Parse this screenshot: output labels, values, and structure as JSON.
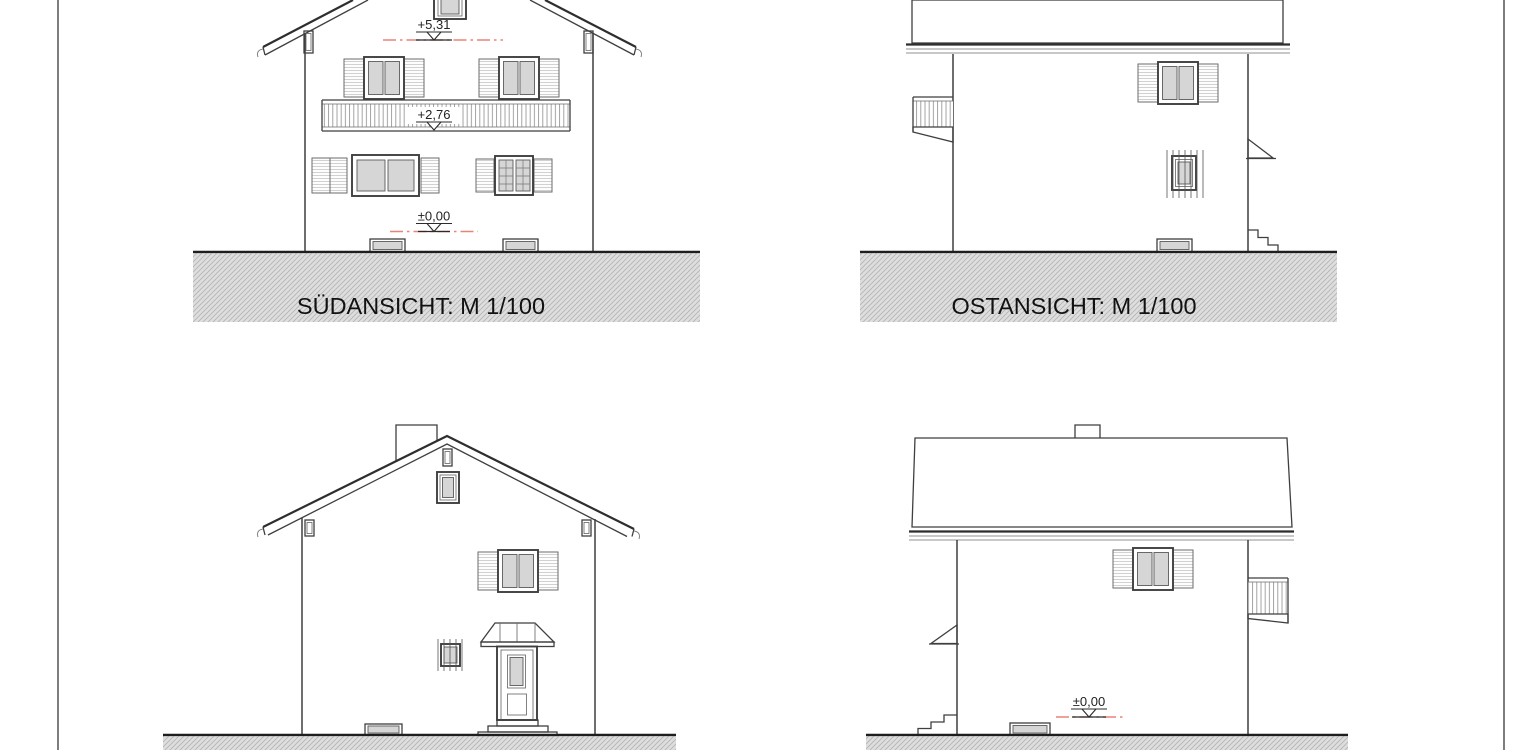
{
  "sheet": {
    "drawing_type": "house elevation drawings (4 views)",
    "scale": "M 1/100"
  },
  "views": {
    "south": {
      "caption": "SÜDANSICHT: M 1/100",
      "levels": {
        "ridge": "+5,31",
        "balcony": "+2,76",
        "ground": "±0,00"
      }
    },
    "east": {
      "caption": "OSTANSICHT: M 1/100"
    },
    "west": {
      "levels": {
        "ground": "±0,00"
      }
    }
  },
  "colors": {
    "line": "#3f3f3f",
    "window_pane": "#d6d6d6",
    "ground_fill": "#dedede",
    "ground_hatch": "#b5b5b5",
    "level_line_red": "#e88478"
  }
}
